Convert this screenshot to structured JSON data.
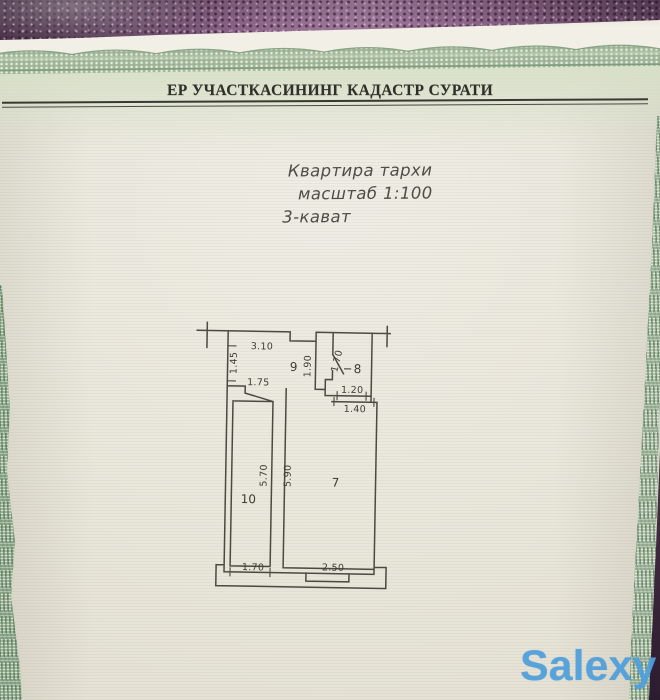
{
  "header": {
    "title": "ЕР УЧАСТКАСИНИНГ КАДАСТР СУРАТИ"
  },
  "caption": {
    "line1": "Квартира тархи",
    "line2": "масштаб 1:100",
    "line3": "3-кават"
  },
  "plan": {
    "rooms": {
      "r9": "9",
      "r8": "8",
      "r10": "10",
      "r7": "7"
    },
    "dims": {
      "d310": "3.10",
      "d145": "1.45",
      "d175": "1.75",
      "d190": "1.90",
      "d170top": "1.70",
      "d120": "1.20",
      "d140": "1.40",
      "d570": "5.70",
      "d590": "5.90",
      "d170bottom": "1.70",
      "d250": "2.50"
    }
  },
  "watermark": {
    "text": "Salexy"
  },
  "colors": {
    "paper": "#e9e6da",
    "border_green": "#9db698",
    "fabric_purple": "#5e3f58",
    "ink": "#454239",
    "watermark_blue": "#4d9fd9"
  }
}
